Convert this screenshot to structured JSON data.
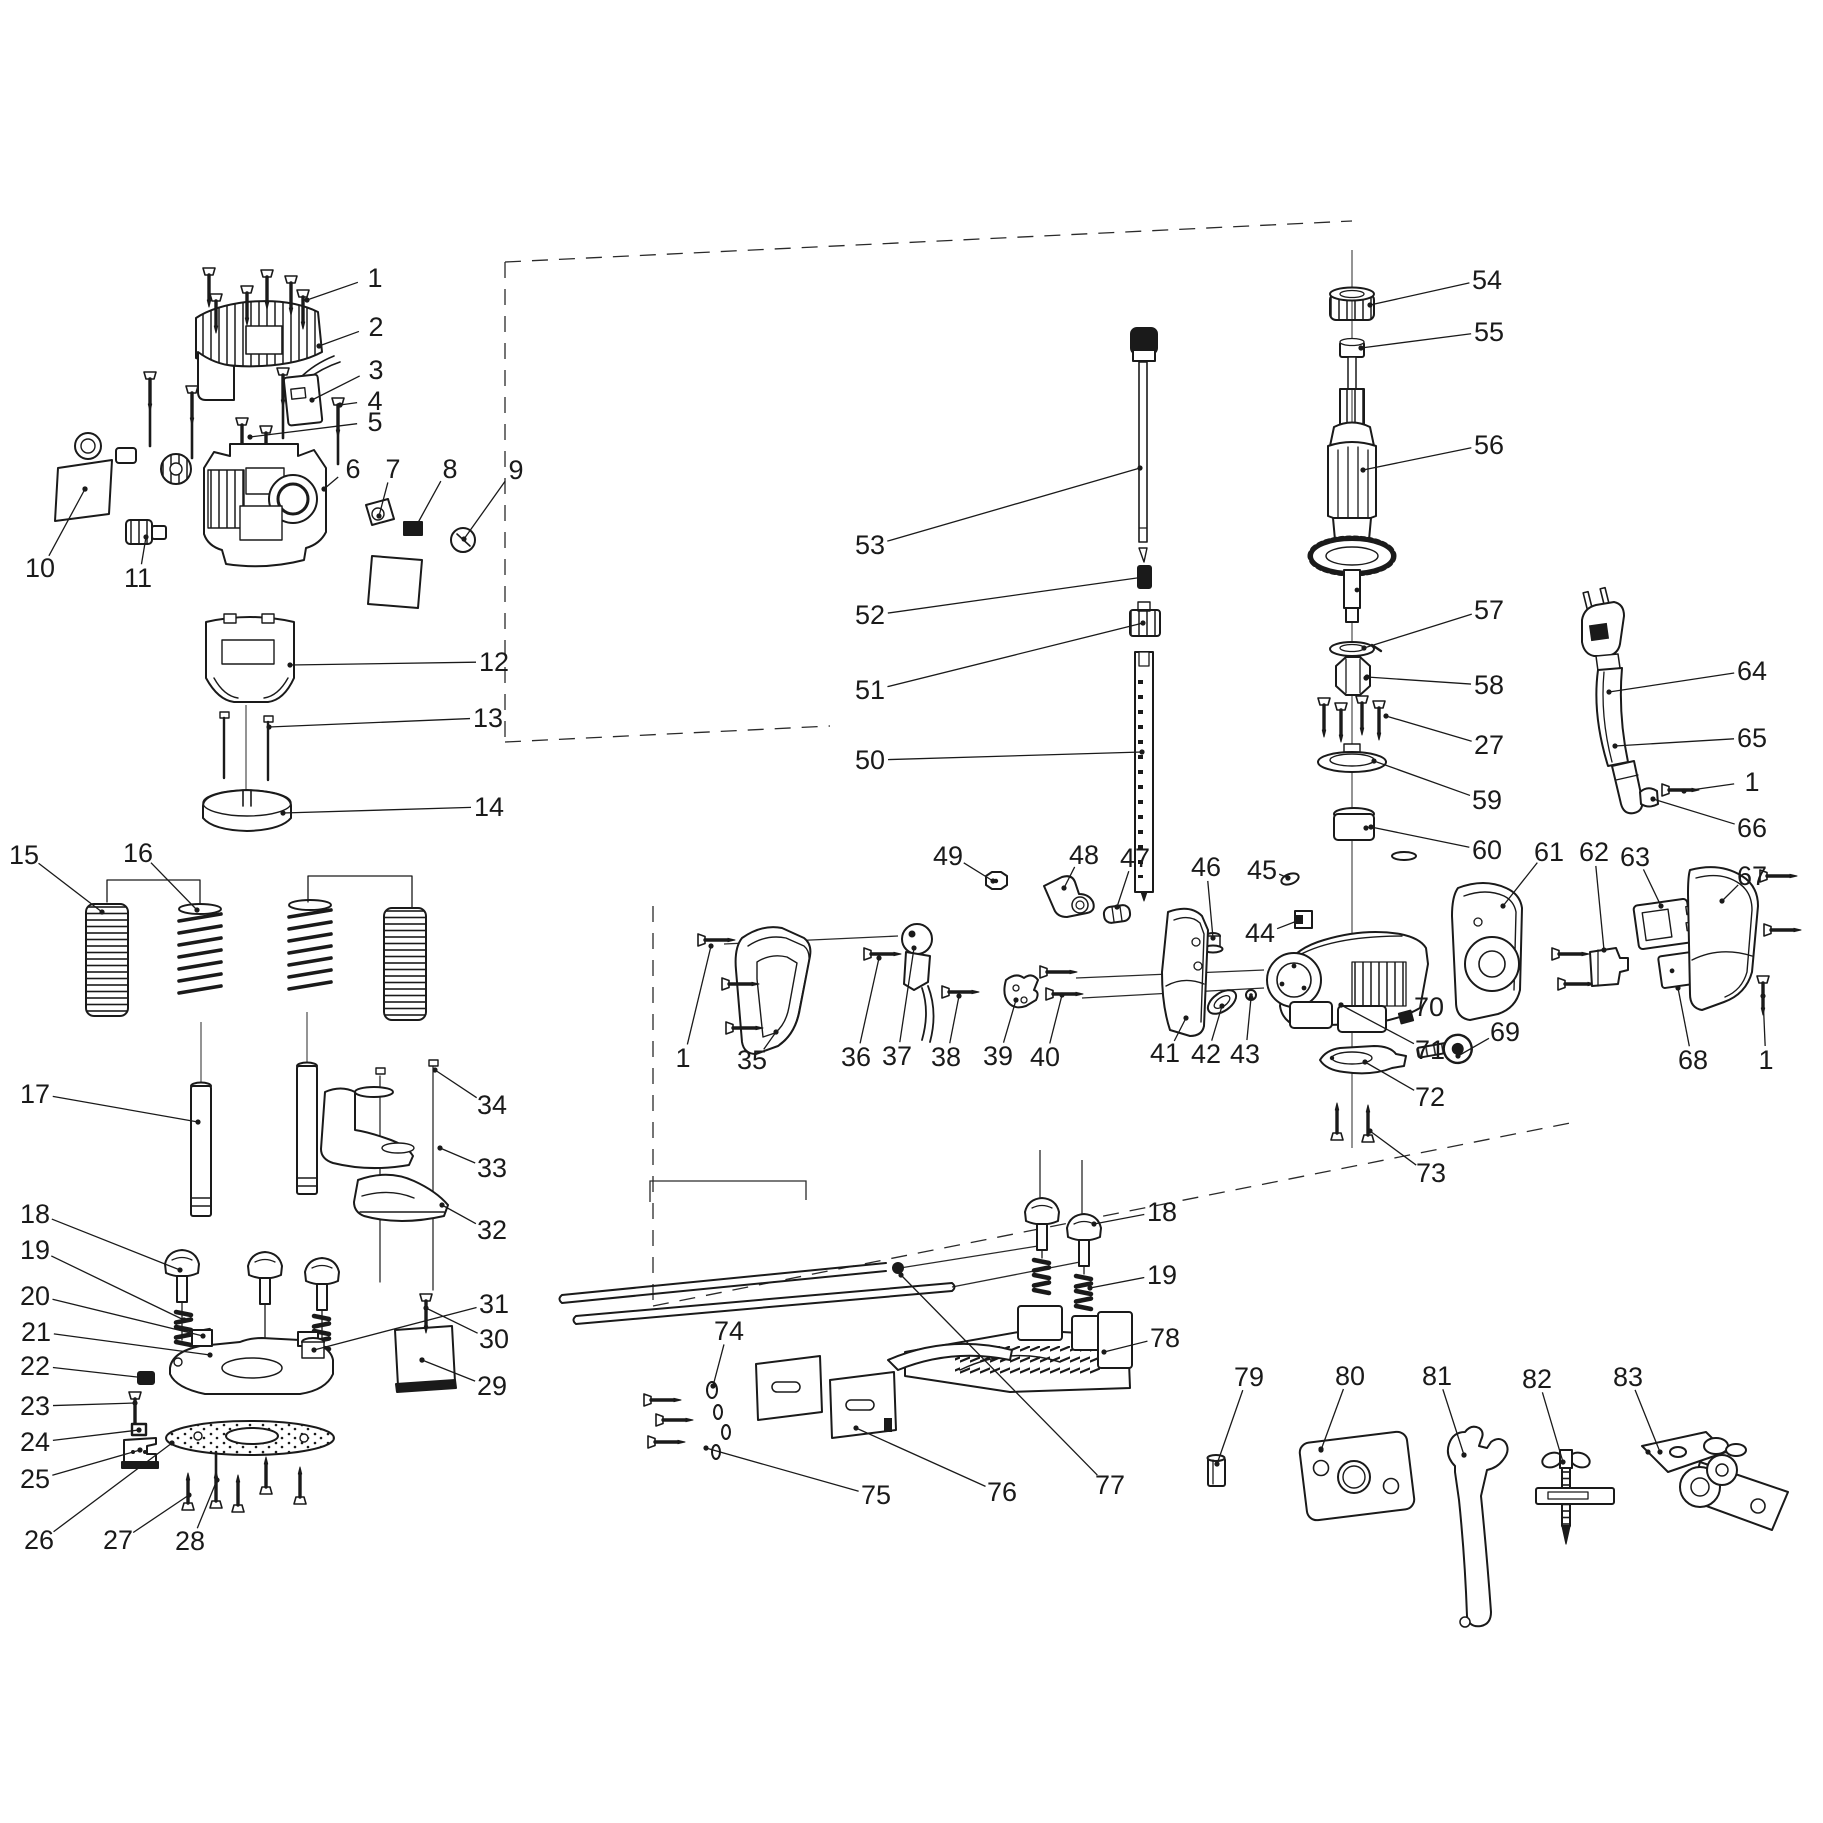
{
  "diagram": {
    "type": "exploded-parts-diagram",
    "line_color": "#1a1a1a",
    "background": "#ffffff",
    "part_numbers_visible": [
      "1",
      "2",
      "3",
      "4",
      "5",
      "6",
      "7",
      "8",
      "9",
      "10",
      "11",
      "12",
      "13",
      "14",
      "15",
      "16",
      "17",
      "18",
      "19",
      "20",
      "21",
      "22",
      "23",
      "24",
      "25",
      "26",
      "27",
      "28",
      "29",
      "30",
      "31",
      "32",
      "33",
      "34",
      "35",
      "36",
      "37",
      "38",
      "39",
      "40",
      "41",
      "42",
      "43",
      "44",
      "45",
      "46",
      "47",
      "48",
      "49",
      "50",
      "51",
      "52",
      "53",
      "54",
      "55",
      "56",
      "57",
      "58",
      "59",
      "60",
      "61",
      "62",
      "63",
      "64",
      "65",
      "66",
      "67",
      "68",
      "69",
      "70",
      "71",
      "72",
      "73",
      "74",
      "75",
      "76",
      "77",
      "78",
      "79",
      "80",
      "81",
      "82",
      "83"
    ],
    "callouts": [
      {
        "n": "1",
        "x": 375,
        "y": 278,
        "tx": 307,
        "ty": 300
      },
      {
        "n": "2",
        "x": 376,
        "y": 327,
        "tx": 319,
        "ty": 346
      },
      {
        "n": "3",
        "x": 376,
        "y": 370,
        "tx": 312,
        "ty": 400
      },
      {
        "n": "4",
        "x": 375,
        "y": 401,
        "tx": 340,
        "ty": 405
      },
      {
        "n": "5",
        "x": 375,
        "y": 422,
        "tx": 250,
        "ty": 437
      },
      {
        "n": "6",
        "x": 353,
        "y": 469,
        "tx": 324,
        "ty": 489
      },
      {
        "n": "7",
        "x": 393,
        "y": 469,
        "tx": 379,
        "ty": 516
      },
      {
        "n": "8",
        "x": 450,
        "y": 469,
        "tx": 414,
        "ty": 530
      },
      {
        "n": "9",
        "x": 516,
        "y": 470,
        "tx": 464,
        "ty": 539
      },
      {
        "n": "10",
        "x": 40,
        "y": 568,
        "tx": 85,
        "ty": 489
      },
      {
        "n": "11",
        "x": 138,
        "y": 578,
        "tx": 146,
        "ty": 537
      },
      {
        "n": "12",
        "x": 494,
        "y": 662,
        "tx": 290,
        "ty": 665
      },
      {
        "n": "13",
        "x": 488,
        "y": 718,
        "tx": 269,
        "ty": 727
      },
      {
        "n": "14",
        "x": 489,
        "y": 807,
        "tx": 283,
        "ty": 813
      },
      {
        "n": "15",
        "x": 24,
        "y": 855,
        "tx": 102,
        "ty": 912
      },
      {
        "n": "16",
        "x": 138,
        "y": 853,
        "tx": 197,
        "ty": 910
      },
      {
        "n": "17",
        "x": 35,
        "y": 1094,
        "tx": 198,
        "ty": 1122
      },
      {
        "n": "18",
        "x": 35,
        "y": 1214,
        "tx": 180,
        "ty": 1270
      },
      {
        "n": "19",
        "x": 35,
        "y": 1250,
        "tx": 184,
        "ty": 1320
      },
      {
        "n": "20",
        "x": 35,
        "y": 1296,
        "tx": 203,
        "ty": 1336
      },
      {
        "n": "21",
        "x": 36,
        "y": 1332,
        "tx": 210,
        "ty": 1355
      },
      {
        "n": "22",
        "x": 35,
        "y": 1366,
        "tx": 146,
        "ty": 1378
      },
      {
        "n": "23",
        "x": 35,
        "y": 1406,
        "tx": 135,
        "ty": 1403
      },
      {
        "n": "24",
        "x": 35,
        "y": 1442,
        "tx": 139,
        "ty": 1430
      },
      {
        "n": "25",
        "x": 35,
        "y": 1479,
        "tx": 140,
        "ty": 1450
      },
      {
        "n": "26",
        "x": 39,
        "y": 1540,
        "tx": 172,
        "ty": 1443
      },
      {
        "n": "27",
        "x": 118,
        "y": 1540,
        "tx": 189,
        "ty": 1495
      },
      {
        "n": "28",
        "x": 190,
        "y": 1541,
        "tx": 217,
        "ty": 1480
      },
      {
        "n": "29",
        "x": 492,
        "y": 1386,
        "tx": 422,
        "ty": 1360
      },
      {
        "n": "30",
        "x": 494,
        "y": 1339,
        "tx": 426,
        "ty": 1308
      },
      {
        "n": "31",
        "x": 494,
        "y": 1304,
        "tx": 314,
        "ty": 1350
      },
      {
        "n": "32",
        "x": 492,
        "y": 1230,
        "tx": 442,
        "ty": 1205
      },
      {
        "n": "33",
        "x": 492,
        "y": 1168,
        "tx": 440,
        "ty": 1148
      },
      {
        "n": "34",
        "x": 492,
        "y": 1105,
        "tx": 435,
        "ty": 1070
      },
      {
        "n": "35",
        "x": 752,
        "y": 1060,
        "tx": 776,
        "ty": 1032
      },
      {
        "n": "1",
        "x": 683,
        "y": 1058,
        "tx": 711,
        "ty": 946
      },
      {
        "n": "36",
        "x": 856,
        "y": 1057,
        "tx": 879,
        "ty": 958
      },
      {
        "n": "37",
        "x": 897,
        "y": 1056,
        "tx": 914,
        "ty": 948
      },
      {
        "n": "38",
        "x": 946,
        "y": 1057,
        "tx": 959,
        "ty": 996
      },
      {
        "n": "39",
        "x": 998,
        "y": 1056,
        "tx": 1016,
        "ty": 1000
      },
      {
        "n": "40",
        "x": 1045,
        "y": 1057,
        "tx": 1062,
        "ty": 995
      },
      {
        "n": "41",
        "x": 1165,
        "y": 1053,
        "tx": 1186,
        "ty": 1018
      },
      {
        "n": "42",
        "x": 1206,
        "y": 1054,
        "tx": 1222,
        "ty": 1006
      },
      {
        "n": "43",
        "x": 1245,
        "y": 1054,
        "tx": 1251,
        "ty": 998
      },
      {
        "n": "44",
        "x": 1260,
        "y": 933,
        "tx": 1297,
        "ty": 921
      },
      {
        "n": "45",
        "x": 1262,
        "y": 870,
        "tx": 1288,
        "ty": 878
      },
      {
        "n": "46",
        "x": 1206,
        "y": 867,
        "tx": 1213,
        "ty": 938
      },
      {
        "n": "47",
        "x": 1135,
        "y": 858,
        "tx": 1117,
        "ty": 907
      },
      {
        "n": "48",
        "x": 1084,
        "y": 855,
        "tx": 1064,
        "ty": 888
      },
      {
        "n": "49",
        "x": 948,
        "y": 856,
        "tx": 993,
        "ty": 881
      },
      {
        "n": "50",
        "x": 870,
        "y": 760,
        "tx": 1142,
        "ty": 752
      },
      {
        "n": "51",
        "x": 870,
        "y": 690,
        "tx": 1143,
        "ty": 623
      },
      {
        "n": "52",
        "x": 870,
        "y": 615,
        "tx": 1144,
        "ty": 577
      },
      {
        "n": "53",
        "x": 870,
        "y": 545,
        "tx": 1140,
        "ty": 468
      },
      {
        "n": "54",
        "x": 1487,
        "y": 280,
        "tx": 1370,
        "ty": 305
      },
      {
        "n": "55",
        "x": 1489,
        "y": 332,
        "tx": 1361,
        "ty": 348
      },
      {
        "n": "56",
        "x": 1489,
        "y": 445,
        "tx": 1363,
        "ty": 470
      },
      {
        "n": "57",
        "x": 1489,
        "y": 610,
        "tx": 1364,
        "ty": 648
      },
      {
        "n": "58",
        "x": 1489,
        "y": 685,
        "tx": 1367,
        "ty": 677
      },
      {
        "n": "27",
        "x": 1489,
        "y": 745,
        "tx": 1386,
        "ty": 716
      },
      {
        "n": "59",
        "x": 1487,
        "y": 800,
        "tx": 1374,
        "ty": 761
      },
      {
        "n": "60",
        "x": 1487,
        "y": 850,
        "tx": 1371,
        "ty": 827
      },
      {
        "n": "61",
        "x": 1549,
        "y": 852,
        "tx": 1503,
        "ty": 906
      },
      {
        "n": "62",
        "x": 1594,
        "y": 852,
        "tx": 1604,
        "ty": 950
      },
      {
        "n": "63",
        "x": 1635,
        "y": 857,
        "tx": 1661,
        "ty": 906
      },
      {
        "n": "64",
        "x": 1752,
        "y": 671,
        "tx": 1609,
        "ty": 692
      },
      {
        "n": "65",
        "x": 1752,
        "y": 738,
        "tx": 1615,
        "ty": 746
      },
      {
        "n": "1",
        "x": 1752,
        "y": 782,
        "tx": 1684,
        "ty": 791
      },
      {
        "n": "66",
        "x": 1752,
        "y": 828,
        "tx": 1653,
        "ty": 799
      },
      {
        "n": "67",
        "x": 1752,
        "y": 876,
        "tx": 1722,
        "ty": 901
      },
      {
        "n": "68",
        "x": 1693,
        "y": 1060,
        "tx": 1678,
        "ty": 988
      },
      {
        "n": "1",
        "x": 1766,
        "y": 1060,
        "tx": 1763,
        "ty": 996
      },
      {
        "n": "69",
        "x": 1505,
        "y": 1032,
        "tx": 1458,
        "ty": 1056
      },
      {
        "n": "70",
        "x": 1429,
        "y": 1007,
        "tx": 1407,
        "ty": 1016
      },
      {
        "n": "71",
        "x": 1430,
        "y": 1050,
        "tx": 1341,
        "ty": 1005
      },
      {
        "n": "72",
        "x": 1430,
        "y": 1097,
        "tx": 1365,
        "ty": 1062
      },
      {
        "n": "73",
        "x": 1431,
        "y": 1173,
        "tx": 1370,
        "ty": 1131
      },
      {
        "n": "18",
        "x": 1162,
        "y": 1212,
        "tx": 1094,
        "ty": 1224
      },
      {
        "n": "19",
        "x": 1162,
        "y": 1275,
        "tx": 1090,
        "ty": 1288
      },
      {
        "n": "78",
        "x": 1165,
        "y": 1338,
        "tx": 1104,
        "ty": 1352
      },
      {
        "n": "74",
        "x": 729,
        "y": 1331,
        "tx": 713,
        "ty": 1386
      },
      {
        "n": "75",
        "x": 876,
        "y": 1495,
        "tx": 706,
        "ty": 1448
      },
      {
        "n": "76",
        "x": 1002,
        "y": 1492,
        "tx": 856,
        "ty": 1428
      },
      {
        "n": "77",
        "x": 1110,
        "y": 1485,
        "tx": 901,
        "ty": 1275
      },
      {
        "n": "79",
        "x": 1249,
        "y": 1377,
        "tx": 1217,
        "ty": 1464
      },
      {
        "n": "80",
        "x": 1350,
        "y": 1376,
        "tx": 1321,
        "ty": 1450
      },
      {
        "n": "81",
        "x": 1437,
        "y": 1376,
        "tx": 1464,
        "ty": 1455
      },
      {
        "n": "82",
        "x": 1537,
        "y": 1379,
        "tx": 1563,
        "ty": 1462
      },
      {
        "n": "83",
        "x": 1628,
        "y": 1377,
        "tx": 1660,
        "ty": 1452
      }
    ]
  }
}
